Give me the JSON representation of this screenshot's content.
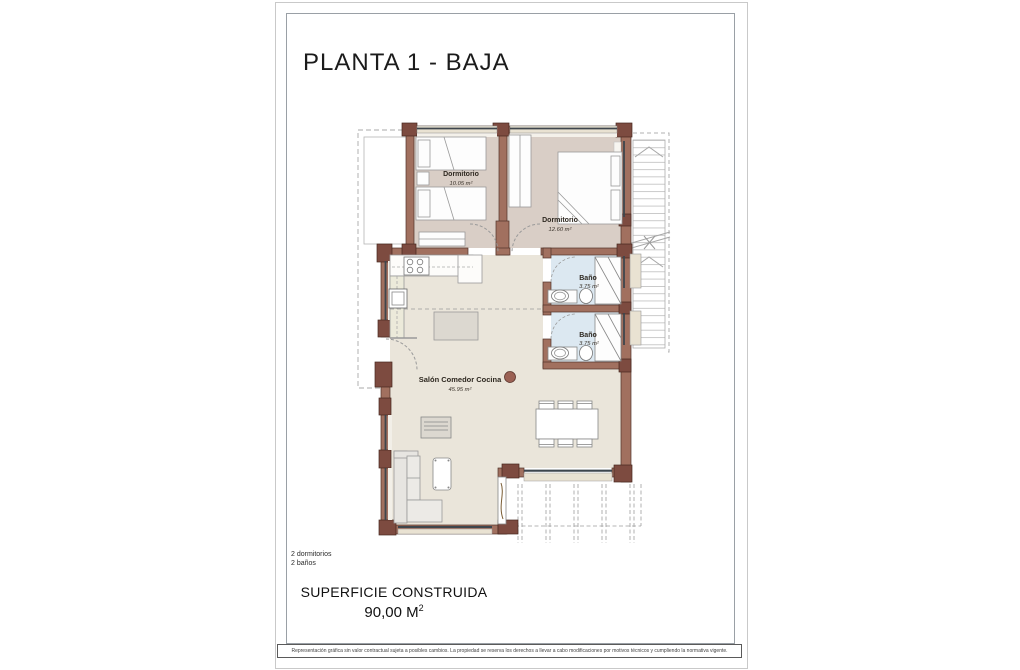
{
  "sheet": {
    "title": "PLANTA 1 - BAJA",
    "summary": {
      "line1": "2 dormitorios",
      "line2": "2 baños"
    },
    "footer": {
      "label": "SUPERFICIE CONSTRUIDA",
      "value": "90,00 M",
      "value_sup": "2"
    },
    "disclaimer": "Representación gráfica sin valor contractual sujeta a posibles cambios. La propiedad se reserva los derechos a llevar a cabo modificaciones por motivos técnicos y cumpliendo la normativa vigente."
  },
  "plan": {
    "rooms": [
      {
        "name": "Dormitorio",
        "area": "10.05 m²"
      },
      {
        "name": "Dormitorio",
        "area": "12.60 m²"
      },
      {
        "name": "Baño",
        "area": "3.75 m²"
      },
      {
        "name": "Baño",
        "area": "3.75 m²"
      },
      {
        "name": "Salón Comedor Cocina",
        "area": "45.95 m²"
      }
    ],
    "colors": {
      "wall": "#a1705f",
      "wall_pier": "#7d4b40",
      "floor_living": "#eae5da",
      "floor_bedroom": "#d9cec6",
      "floor_bath": "#dce8f1",
      "window_sill": "#e9e2d2",
      "window_glass": "#3e464d",
      "column": "#9b6154"
    }
  }
}
